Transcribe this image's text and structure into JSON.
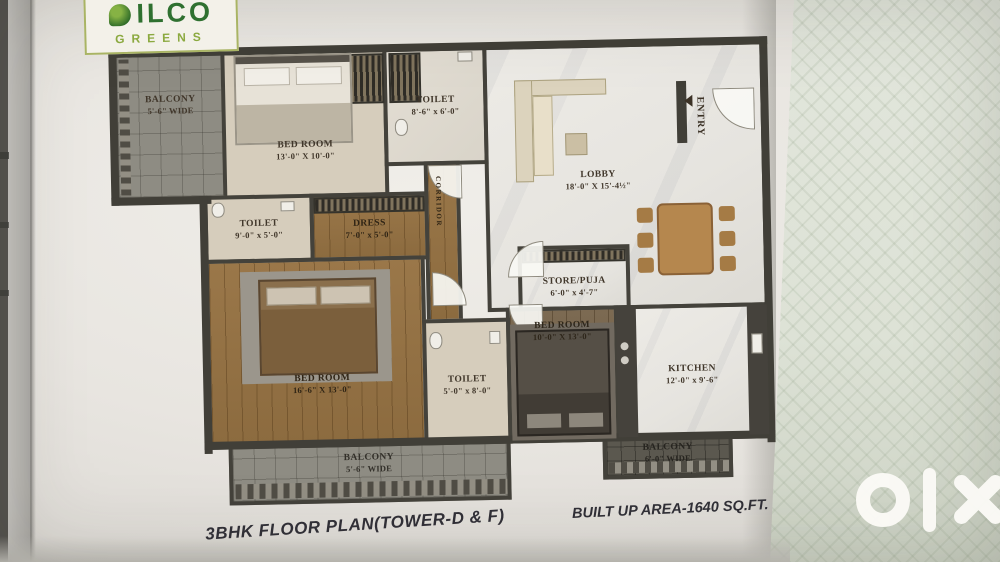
{
  "brand": {
    "name": "ILCO",
    "sub": "GREENS"
  },
  "rooms": {
    "balcony_top": {
      "name": "BALCONY",
      "dims": "5'-6\" WIDE"
    },
    "bedroom1": {
      "name": "BED ROOM",
      "dims": "13'-0\" X 10'-0\""
    },
    "toilet_top": {
      "name": "TOILET",
      "dims": "8'-6\" x 6'-0\""
    },
    "entry": {
      "name": "ENTRY"
    },
    "lobby": {
      "name": "LOBBY",
      "dims": "18'-0\" X 15'-4½\""
    },
    "toilet_left": {
      "name": "TOILET",
      "dims": "9'-0\" x 5'-0\""
    },
    "dress": {
      "name": "DRESS",
      "dims": "7'-0\" x 5'-0\""
    },
    "corridor": {
      "name": "CORRIDOR"
    },
    "store": {
      "name": "STORE/PUJA",
      "dims": "6'-0\" x 4'-7\""
    },
    "bedroom2": {
      "name": "BED ROOM",
      "dims": "10'-0\" X 13'-0\""
    },
    "bedroom3": {
      "name": "BED ROOM",
      "dims": "16'-6\" X 13'-0\""
    },
    "toilet_bottom": {
      "name": "TOILET",
      "dims": "5'-0\" x 8'-0\""
    },
    "kitchen": {
      "name": "KITCHEN",
      "dims": "12'-0\" x 9'-6\""
    },
    "balcony_bottom": {
      "name": "BALCONY",
      "dims": "5'-6\" WIDE"
    },
    "balcony_right": {
      "name": "BALCONY",
      "dims": "6'-0\" WIDE"
    }
  },
  "captions": {
    "plan_title": "3BHK FLOOR PLAN(TOWER-D & F)",
    "built_up": "BUILT UP AREA-1640 SQ.FT."
  },
  "colors": {
    "logo_green": "#2f7030",
    "logo_accent": "#a9b464",
    "wall": "#44423b",
    "wood": "#95734a",
    "paper": "#e9e6e1",
    "olx_background": "#dee3d8",
    "watermark_white": "#fbfaf6"
  }
}
